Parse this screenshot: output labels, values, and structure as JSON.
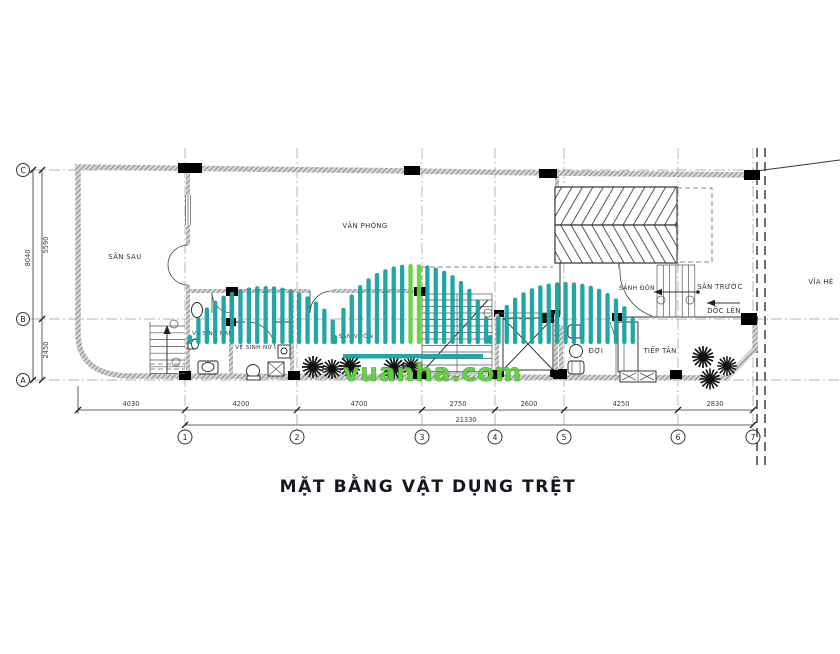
{
  "title": "MẶT BẰNG VẬT DỤNG TRỆT",
  "watermark": {
    "text": "vuanha.com",
    "teal": "#17a3a1",
    "green": "#64d13e"
  },
  "rooms": {
    "san_sau": "SÂN SAU",
    "van_phong": "VĂN PHÒNG",
    "ve_sinh_nam": "VỆ SINH NAM",
    "ve_sinh_nu": "VỆ SINH NỮ",
    "san_vuon": "SÂN VƯỜN",
    "sanh_don": "SẢNH ĐÓN",
    "san_truoc": "SÂN TRƯỚC",
    "doc_len": "DỐC LÊN",
    "via_he": "VỈA HÈ",
    "doi": "ĐỢI",
    "tiep_tan": "TIẾP TÂN"
  },
  "grid": {
    "columns": [
      "1",
      "2",
      "3",
      "4",
      "5",
      "6",
      "7"
    ],
    "rows": [
      "C",
      "B",
      "A"
    ]
  },
  "dimensions": {
    "bottom": [
      "4030",
      "4200",
      "4700",
      "2750",
      "2600",
      "4250",
      "2830"
    ],
    "total": "21330",
    "left": {
      "overall": "8040",
      "b_c": "5590",
      "a_b": "2450"
    }
  }
}
